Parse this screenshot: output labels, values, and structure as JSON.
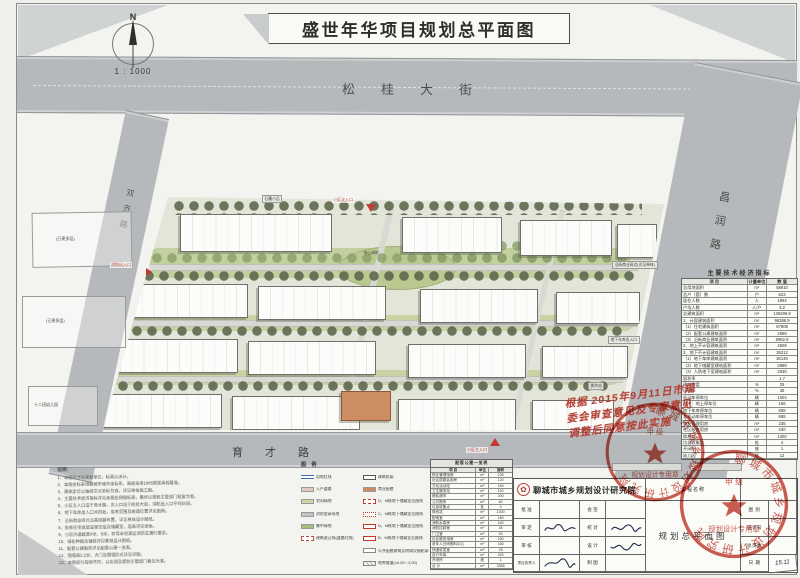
{
  "title": "盛世年华项目规划总平面图",
  "north": {
    "letter": "N",
    "scale": "1 : 1000"
  },
  "roads": {
    "top": "松桂大街",
    "right": "昌润路",
    "bottom": "育才路",
    "left": "双齐路"
  },
  "plan": {
    "entrances": {
      "top": "小区次入口",
      "bottom": "小区主入口",
      "west": "消防出入口"
    },
    "callouts": {
      "c1": "石雕小品",
      "c2": "沿街商业网点(详见单体)",
      "c3": "地下车库出入口",
      "c4": "换热站",
      "c5": "中心绿地"
    },
    "neighbors": {
      "n1": "(已建多层)",
      "n2": "(已建多层)",
      "n3": "十二班幼儿园"
    }
  },
  "indicators": {
    "title": "主要技术经济指标",
    "columns": [
      "项  目",
      "计量单位",
      "数  值"
    ],
    "rows": [
      [
        "总用地面积",
        "m²",
        "58910"
      ],
      [
        "总户（套）数",
        "户",
        "623"
      ],
      [
        "居住人数",
        "人",
        "1994"
      ],
      [
        "户均人数",
        "人/户",
        "3.2"
      ],
      [
        "总建筑面积",
        "m²",
        "136206.9"
      ],
      [
        "1、计容建筑面积",
        "m²",
        "96386.9"
      ],
      [
        "（1）住宅建筑面积",
        "m²",
        "87808"
      ],
      [
        "（2）配套公建建筑面积",
        "m²",
        "2596"
      ],
      [
        "（3）沿街商业建筑面积",
        "m²",
        "5982.9"
      ],
      [
        "2、地上不计容建筑面积",
        "m²",
        "4508"
      ],
      [
        "3、地下不计容建筑面积",
        "m²",
        "35312"
      ],
      [
        "（1）地下车库建筑面积",
        "m²",
        "30140"
      ],
      [
        "（2）地下储藏室建筑面积",
        "m²",
        "2898"
      ],
      [
        "（3）人防地下室建筑面积",
        "m²",
        "2630"
      ],
      [
        "容积率",
        "",
        "1.7"
      ],
      [
        "建筑密度",
        "%",
        "25"
      ],
      [
        "绿地率",
        "%",
        "35"
      ],
      [
        "机动车停车位",
        "辆",
        "1004"
      ],
      [
        "其中：地上停车位",
        "辆",
        "166"
      ],
      [
        "地下车库停车位",
        "辆",
        "838"
      ],
      [
        "非机动车停车位",
        "辆",
        "698"
      ],
      [
        "物业管理用房",
        "m²",
        "235"
      ],
      [
        "社区服务用房",
        "m²",
        "230"
      ],
      [
        "换热站",
        "m²",
        "1300"
      ],
      [
        "垃圾收集点",
        "处",
        "4"
      ],
      [
        "开闭所",
        "座",
        "1"
      ],
      [
        "幼儿园",
        "班",
        "12"
      ]
    ]
  },
  "detail_table": {
    "title": "配套公建一览表",
    "columns": [
      "项 目",
      "单位",
      "面积"
    ],
    "rows": [
      [
        "物业管理用房",
        "m²",
        "235"
      ],
      [
        "社区居委会用房",
        "m²",
        "120"
      ],
      [
        "文化活动站",
        "m²",
        "150"
      ],
      [
        "卫生服务站",
        "m²",
        "120"
      ],
      [
        "便民超市",
        "m²",
        "200"
      ],
      [
        "公共厕所",
        "m²",
        "60"
      ],
      [
        "垃圾收集点",
        "处",
        "4"
      ],
      [
        "换热站",
        "m²",
        "1300"
      ],
      [
        "配电室",
        "m²",
        "180"
      ],
      [
        "消防水泵房",
        "m²",
        "160"
      ],
      [
        "消防控制室",
        "m²",
        "45"
      ],
      [
        "门卫室",
        "m²",
        "30"
      ],
      [
        "社区服务用房",
        "m²",
        "230"
      ],
      [
        "老年人日间照料中心",
        "m²",
        "180"
      ],
      [
        "快递收发室",
        "m²",
        "25"
      ],
      [
        "自行车库",
        "m²",
        "320"
      ],
      [
        "开闭所",
        "座",
        "1"
      ],
      [
        "合 计",
        "m²",
        "3355"
      ]
    ]
  },
  "legend": {
    "title": "图 例",
    "left": [
      {
        "sw": "sw-redline",
        "label": "用地红线"
      },
      {
        "sw": "sw-pink",
        "label": "入户道路"
      },
      {
        "sw": "sw-green",
        "label": "宅间绿地"
      },
      {
        "sw": "sw-grey",
        "label": "消防登高场地"
      },
      {
        "sw": "sw-mottle",
        "label": "集中绿地"
      },
      {
        "sw": "sw-dash",
        "label": "建筑退让线(道路红线)"
      }
    ],
    "right": [
      {
        "sw": "sw-white",
        "label": "建筑轮廓"
      },
      {
        "sw": "sw-orange",
        "label": "商业配套"
      },
      {
        "sw": "sw-rd1",
        "label": "D、M栋地下储藏室范围线"
      },
      {
        "sw": "sw-rd2",
        "label": "C、M栋地下储藏室范围线"
      },
      {
        "sw": "sw-rd3",
        "label": "N、M栋地下储藏室范围线"
      },
      {
        "sw": "sw-rd4",
        "label": "B、M栋地下储藏室范围线"
      },
      {
        "sw": "sw-outline",
        "label": "公共配套建筑及附属设施轮廓"
      },
      {
        "sw": "sw-hatch",
        "label": "地库坡道(±0.00~-3.90)"
      }
    ]
  },
  "notes": {
    "title": "说明:",
    "lines": [
      "1、本图尺寸以米为单位，标高以米计。",
      "2、本图坐标采用聊城市城市坐标系，高程采用1985国家高程基准。",
      "3、建筑定位以轴线交点坐标为准，详见单体施工图。",
      "4、主要技术经济指标详见本图右侧指标表，最终以规划主管部门批复为准。",
      "5、小区主入口设于育才路，次入口设于松桂大街，消防出入口平时封闭。",
      "6、地下车库出入口共四处，车库范围及坡道位置详见图例。",
      "7、沿街商业网点沿昌润路布置，详见单体设计图纸。",
      "8、各栋住宅底层设架空层及储藏室，层高详见单体。",
      "9、小区内道路宽4米、6米，转弯半径满足消防车通行要求。",
      "10、绿化种植及铺装详见景观设计图纸。",
      "11、配套公建面积详见配套公建一览表。",
      "12、围墙高2.2米，大门及围墙形式详见详图。",
      "13、本图如与现场不符，以实测及规划主管部门意见为准。"
    ]
  },
  "title_block": {
    "institute": "聊城市城乡规划设计研究院",
    "project_label": "工程名称",
    "drawing_name": "规划总平面图",
    "rows": [
      {
        "l1": "批 准",
        "l2": "会 签"
      },
      {
        "l1": "审 定",
        "l2": "校 对"
      },
      {
        "l1": "审 核",
        "l2": "设 计"
      },
      {
        "l1": "项目负责人",
        "l2": "制 图"
      }
    ],
    "right_rows": [
      {
        "label": "图 别",
        "value": ""
      },
      {
        "label": "设计号",
        "value": ""
      },
      {
        "label": "总页数",
        "value": ""
      },
      {
        "label": "日 期",
        "value": "15.11"
      }
    ]
  },
  "annotation": {
    "lines": [
      "根据 2015年9月11日市规",
      "委会审查意见及专家意见",
      "调整后同意按此实施"
    ]
  },
  "stamp": {
    "ring": "聊城市城乡规划设计研究院",
    "sub": "规划设计专用章",
    "grade": "甲 级",
    "star": "★"
  },
  "colors": {
    "stamp_red": "#c0392b",
    "annotation_red": "#b23a30",
    "entrance_red": "#c23a32",
    "road_grey": "#b6b9bb",
    "green": "#c3cf9e"
  }
}
